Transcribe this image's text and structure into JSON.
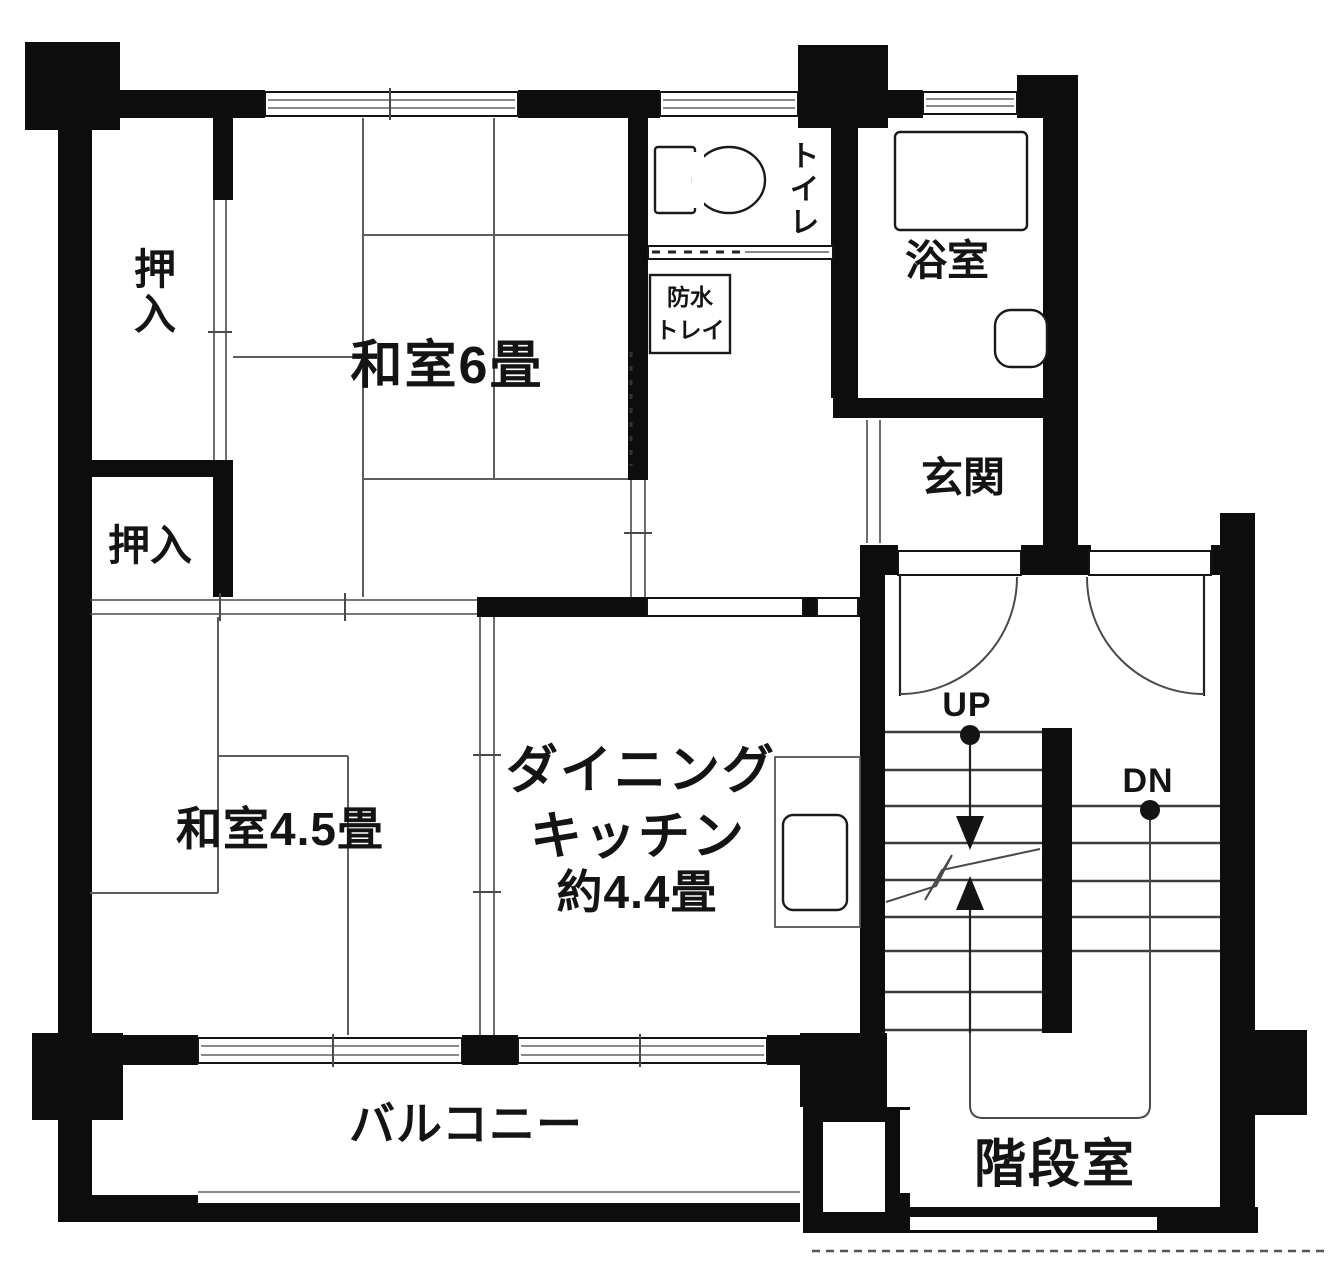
{
  "plan": {
    "type": "floor-plan",
    "colors": {
      "wall": "#0d0d0d",
      "background": "#ffffff",
      "tatami_line": "#5d5d5d",
      "glass_line": "#8a8a8a"
    },
    "rooms": {
      "washitsu_6": {
        "label": "和室6畳"
      },
      "washitsu_45": {
        "label": "和室4.5畳"
      },
      "dining_kitchen": {
        "name_line1": "ダイニング",
        "name_line2": "キッチン",
        "size": "約4.4畳"
      },
      "closet_upper": {
        "label": "押入"
      },
      "closet_lower": {
        "label": "押入"
      },
      "toilet": {
        "label": "トイレ"
      },
      "waterproof_tray": {
        "line1": "防水",
        "line2": "トレイ"
      },
      "bathroom": {
        "label": "浴室"
      },
      "entrance": {
        "label": "玄関"
      },
      "balcony": {
        "label": "バルコニー"
      },
      "stairwell": {
        "label": "階段室"
      }
    },
    "stairs": {
      "up_label": "UP",
      "down_label": "DN"
    }
  }
}
